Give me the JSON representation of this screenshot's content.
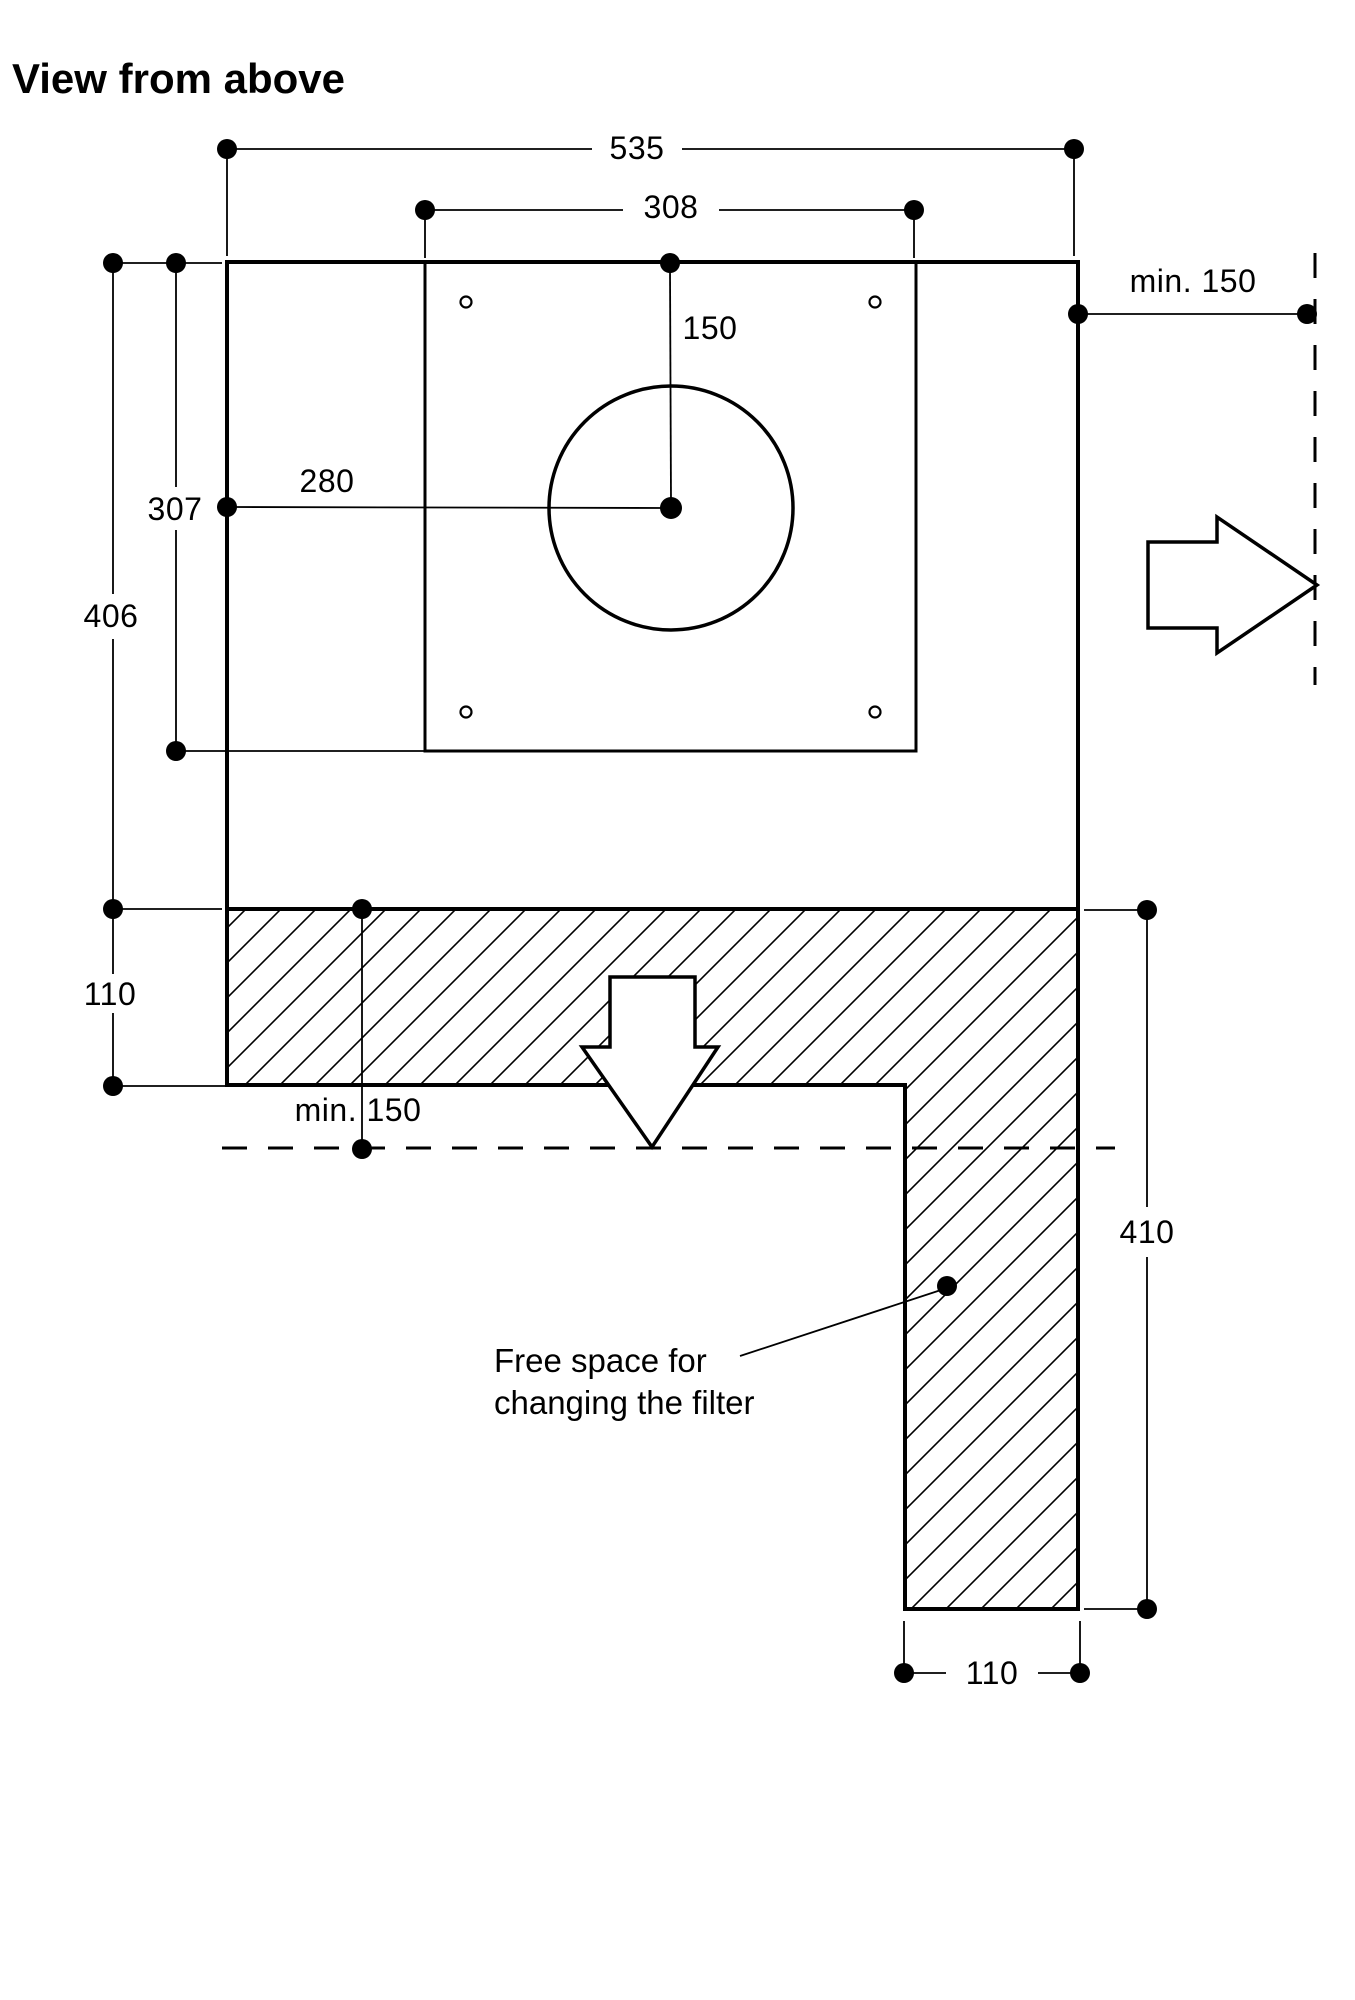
{
  "page": {
    "background": "#ffffff",
    "line_color": "#000000",
    "view": "top-view installation drawing"
  },
  "header": {
    "title": "View from above"
  },
  "dimensions": {
    "width_total": "535",
    "width_inner": "308",
    "clearance_right": "min. 150",
    "duct_offset_top": "150",
    "duct_offset_left": "280",
    "inner_depth": "307",
    "body_depth": "406",
    "strip_depth": "110",
    "clearance_front": "min. 150",
    "free_space_depth": "410",
    "column_width": "110"
  },
  "annotations": {
    "free_space_note": "Free space for changing the filter",
    "free_space_line1": "Free space for",
    "free_space_line2": "changing the filter"
  },
  "icons": {
    "right_arrow": "right-arrow-icon",
    "down_arrow": "down-arrow-icon"
  }
}
